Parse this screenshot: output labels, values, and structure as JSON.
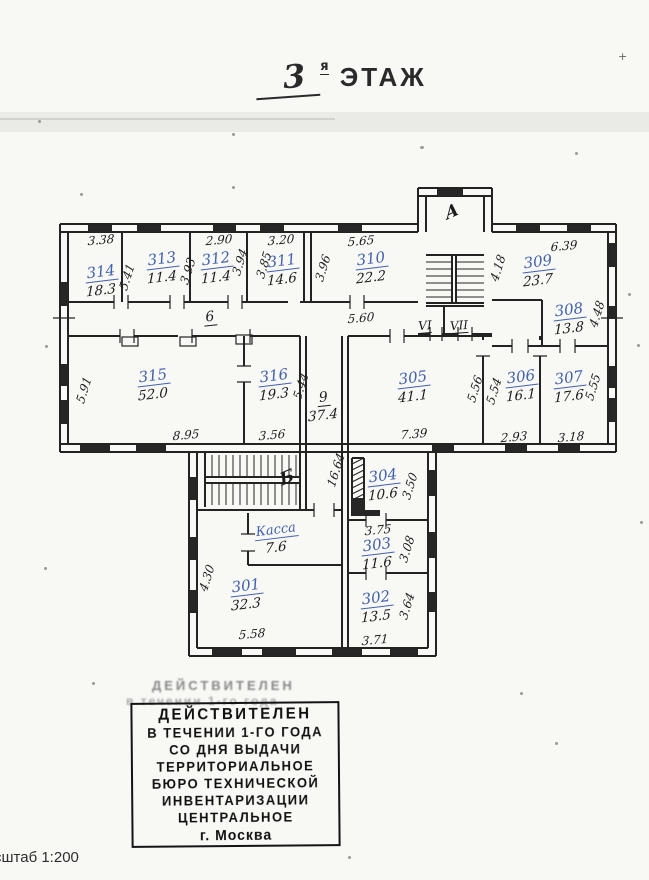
{
  "title": {
    "number": "3",
    "superscript": "я",
    "word": "ЭТАЖ"
  },
  "scale_label": "сштаб 1:200",
  "stamp": {
    "ghost_lines": [
      "ДЕЙСТВИТЕЛЕН",
      "в течении 1-го года"
    ],
    "lines": [
      "ДЕЙСТВИТЕЛЕН",
      "В ТЕЧЕНИИ 1-ГО ГОДА",
      "СО ДНЯ ВЫДАЧИ",
      "ТЕРРИТОРИАЛЬНОЕ",
      "БЮРО ТЕХНИЧЕСКОЙ",
      "ИНВЕНТАРИЗАЦИИ",
      "ЦЕНТРАЛЬНОЕ",
      "г. Москва"
    ]
  },
  "plan": {
    "staircases": [
      {
        "label": "А"
      },
      {
        "label": "Б"
      }
    ],
    "corridors": {
      "c6": {
        "label": "6"
      },
      "c9": {
        "label": "9",
        "area": "37.4"
      },
      "v6": {
        "label": "VI"
      },
      "v7": {
        "label": "VII"
      }
    },
    "rooms": [
      {
        "number": "314",
        "area": "18.3"
      },
      {
        "number": "313",
        "area": "11.4"
      },
      {
        "number": "312",
        "area": "11.4"
      },
      {
        "number": "311",
        "area": "14.6"
      },
      {
        "number": "310",
        "area": "22.2"
      },
      {
        "number": "309",
        "area": "23.7"
      },
      {
        "number": "308",
        "area": "13.8"
      },
      {
        "number": "315",
        "area": "52.0"
      },
      {
        "number": "316",
        "area": "19.3"
      },
      {
        "number": "305",
        "area": "41.1"
      },
      {
        "number": "306",
        "area": "16.1"
      },
      {
        "number": "307",
        "area": "17.6"
      },
      {
        "number": "304",
        "area": "10.6"
      },
      {
        "number": "303",
        "area": "11.6"
      },
      {
        "number": "302",
        "area": "13.5"
      },
      {
        "number": "301",
        "area": "32.3"
      },
      {
        "number": "Касса",
        "area": "7.6"
      }
    ],
    "dims": {
      "w314": "3.38",
      "w312": "2.90",
      "w311": "3.20",
      "w310": "5.65",
      "w309": "6.39",
      "h314": "5.41",
      "h313": "3.93",
      "h312": "3.94",
      "h311": "3.85",
      "h310": "3.96",
      "h309": "4.18",
      "corr6_len": "5.60",
      "h308": "4.48",
      "h315": "5.91",
      "w315": "8.95",
      "w316": "3.56",
      "h316": "5.44",
      "w305": "7.39",
      "h306l": "5.56",
      "h306r": "5.54",
      "w306": "2.93",
      "w307": "3.18",
      "h307": "5.55",
      "hall_len": "16.64",
      "h304": "3.50",
      "w303": "3.75",
      "h303": "3.08",
      "h302": "3.64",
      "w302": "3.71",
      "h301": "4.30",
      "w301": "5.58"
    }
  }
}
